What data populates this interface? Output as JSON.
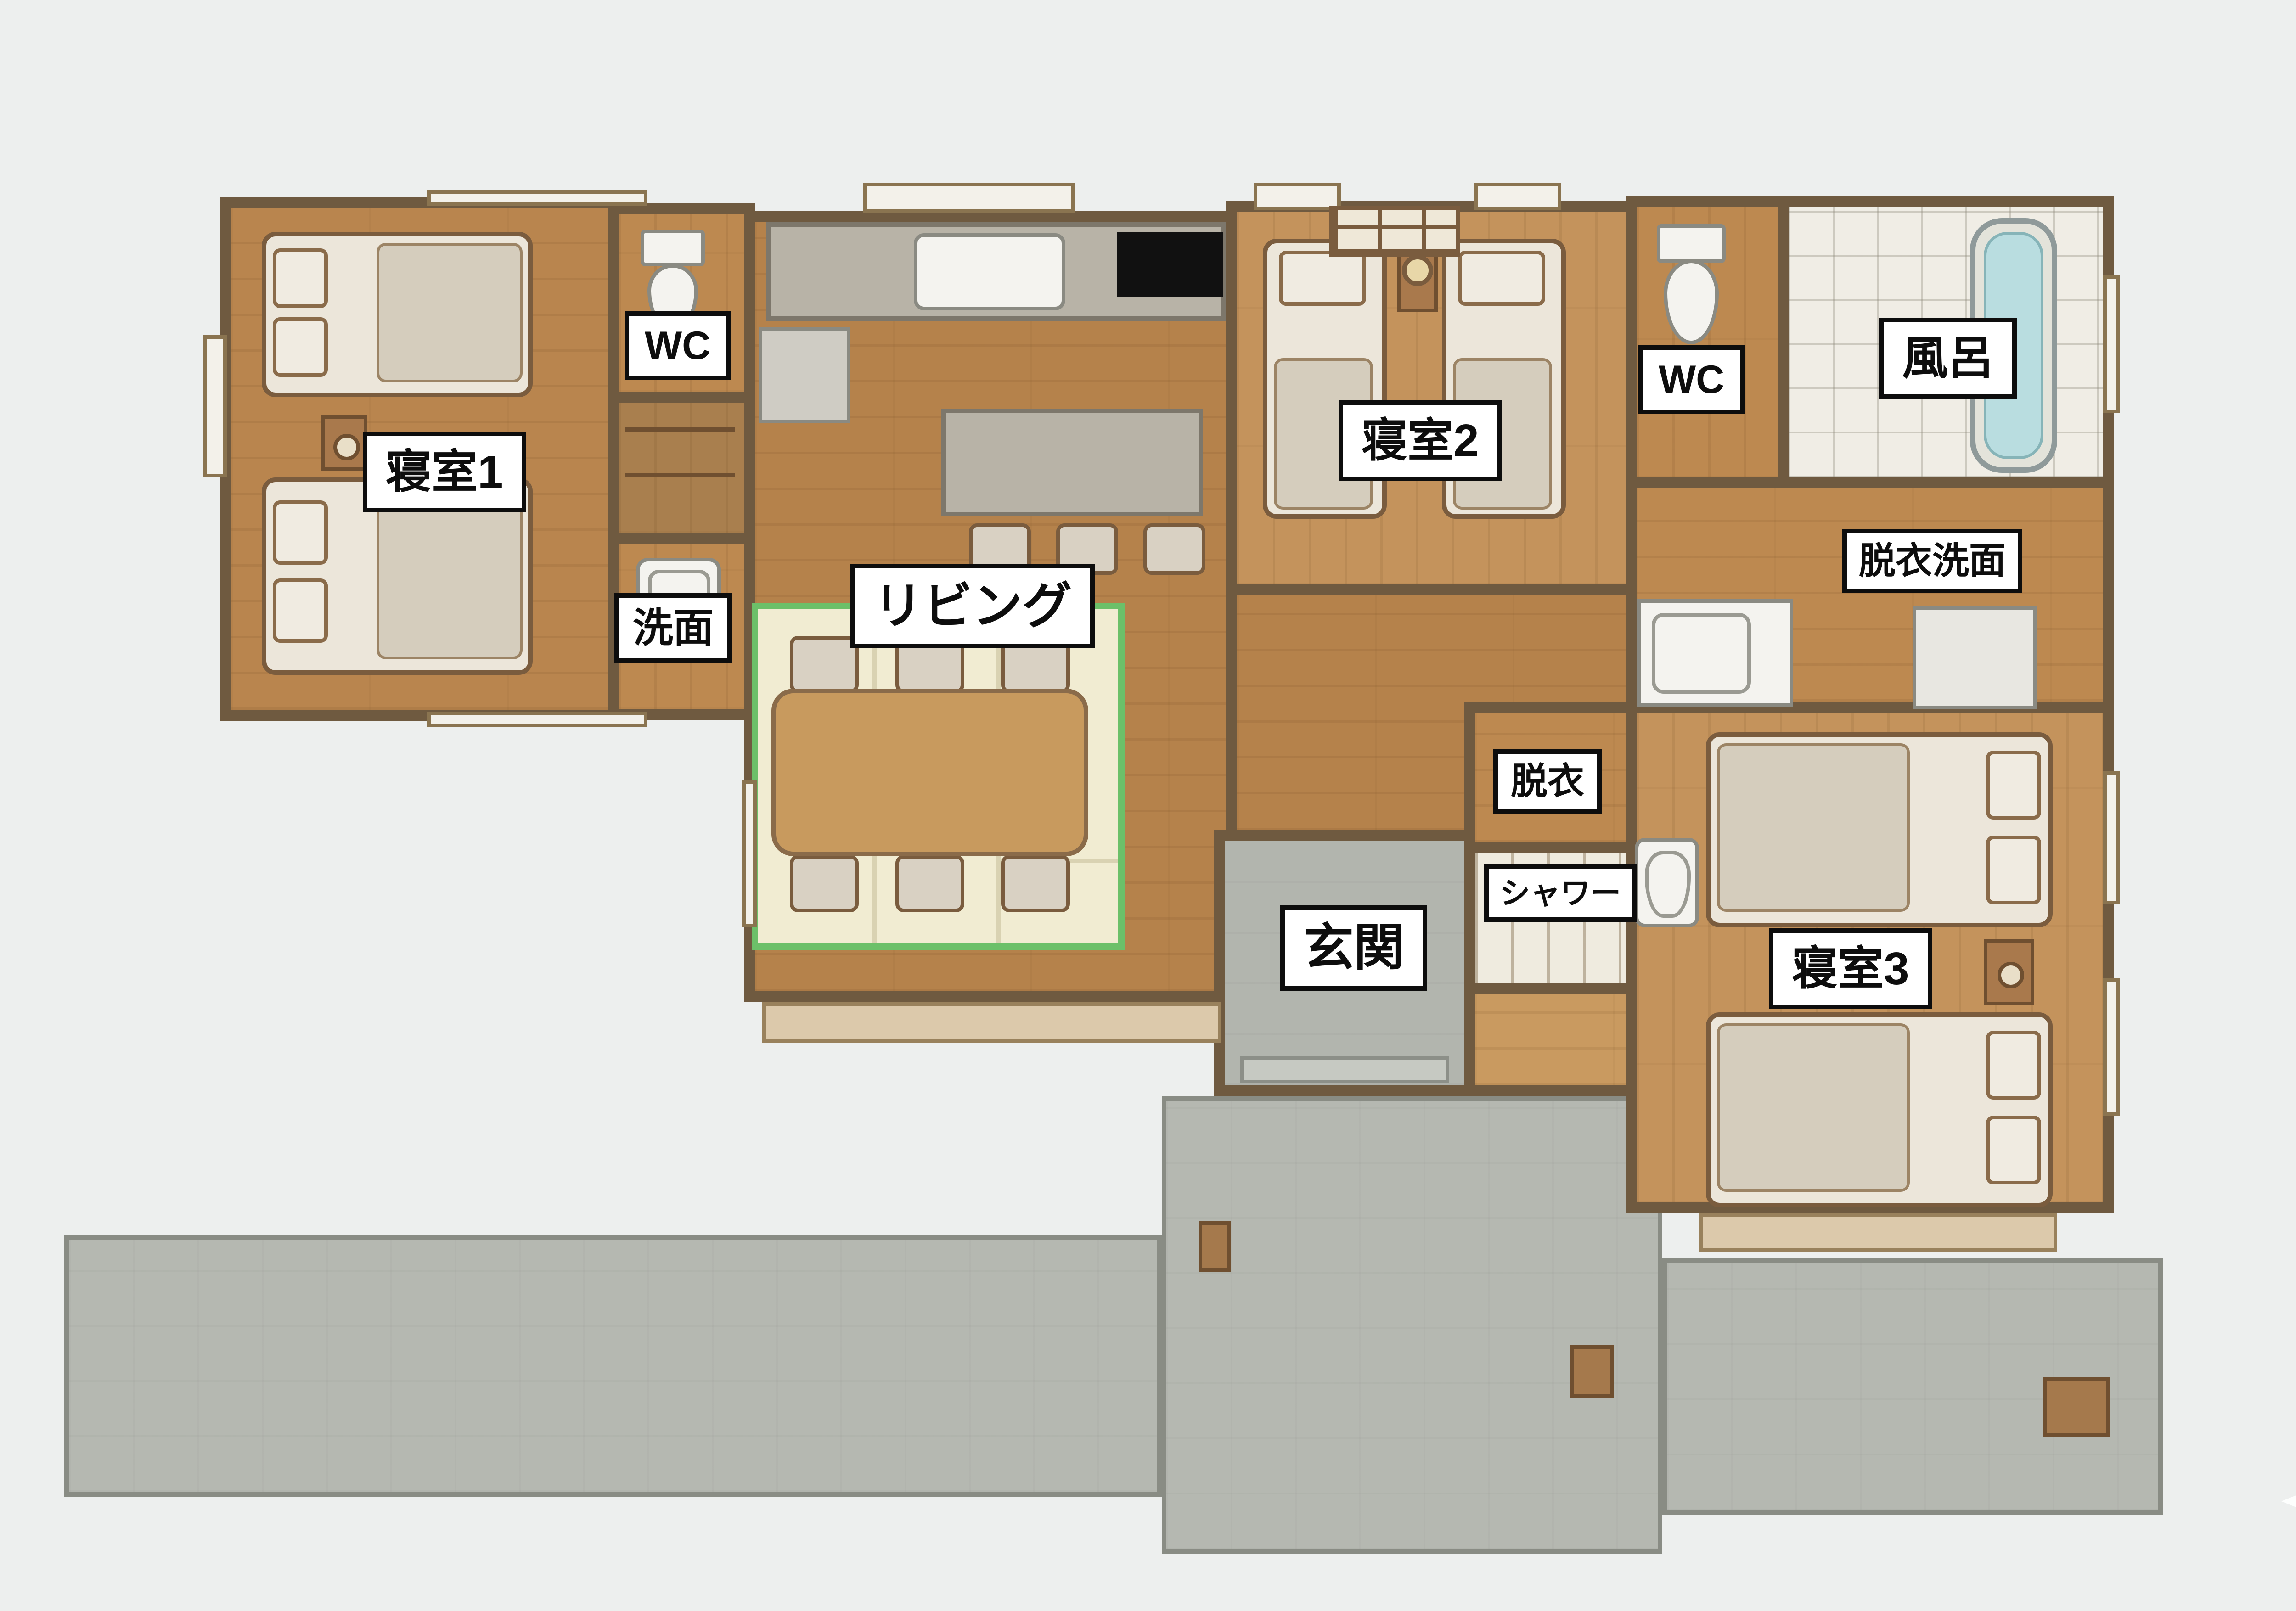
{
  "title": "平屋 間取り図 (one-story house floor plan)",
  "labels": {
    "bedroom1": "寝室1",
    "wc_left": "WC",
    "washroom": "洗面",
    "living": "リビング",
    "bedroom2": "寝室2",
    "wc_right": "WC",
    "bath": "風呂",
    "dressing_washroom": "脱衣洗面",
    "dressing": "脱衣",
    "shower": "シャワー",
    "entrance": "玄関",
    "bedroom3": "寝室3"
  },
  "colors": {
    "background": "#edefee",
    "wall": "#6f5a40",
    "wood_floor": "#b5824b",
    "wood_floor_light": "#c4935c",
    "tatami": "#f1ecd2",
    "tatami_border": "#6cc069",
    "concrete": "#b5b8b1",
    "counter_gray": "#b8b3a7",
    "bath_water": "#b9dde0",
    "label_bg": "#ffffff",
    "label_text": "#0d0d0d"
  },
  "icons": {
    "sparkle": "four-point-star"
  }
}
